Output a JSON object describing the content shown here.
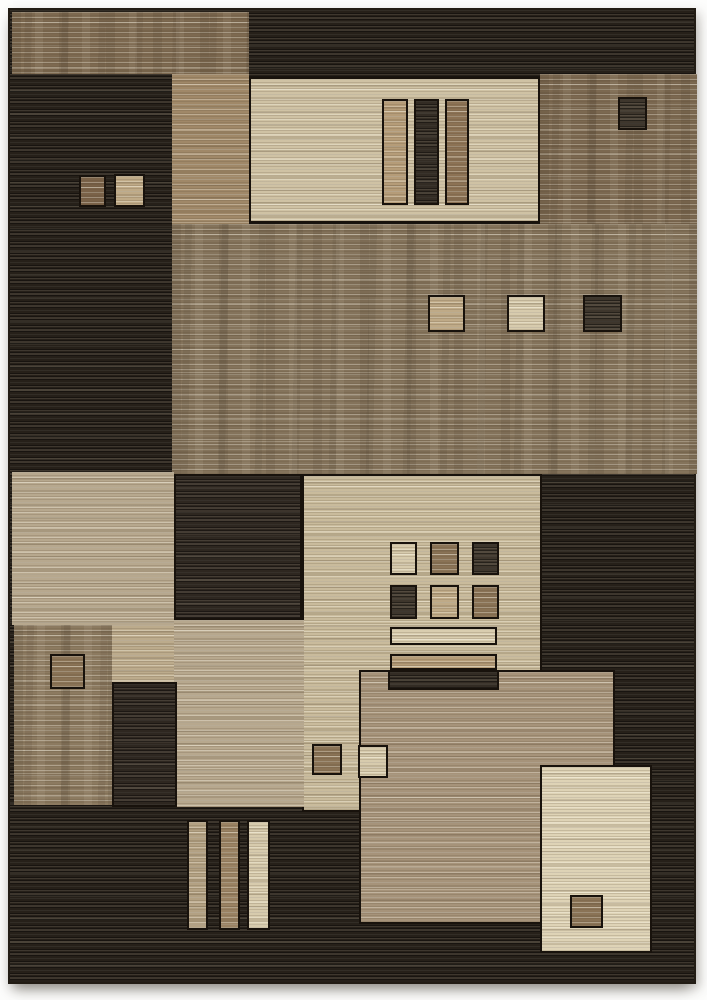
{
  "image": {
    "width": 707,
    "height": 1000,
    "background": "#fdfdfc",
    "alt": "Product photo of a modern geometric area rug with brown, tan, beige and cream color blocks and horizontal striated texture"
  },
  "rug": {
    "x": 8,
    "y": 8,
    "width": 688,
    "height": 976,
    "base_fill": "darkBase",
    "edge_color": "#221c14"
  },
  "palette": {
    "darkBase": "#262019",
    "dark2": "#2e2720",
    "brownTop": "#7d6950",
    "brownRight": "#7b6850",
    "tanColumn": "#a08868",
    "cream": "#cfc2a4",
    "creamBright": "#d9cdaf",
    "tanField": "#84735b",
    "beige": "#b7a88e",
    "beigeLow": "#bcab8c",
    "creamMid": "#c9bb9c",
    "tanLow": "#a6937a",
    "brownLow": "#8c7a60",
    "barTan": "#b59c78",
    "barBrown": "#8c7254",
    "barDark": "#332c24",
    "sqDark": "#3e362c",
    "sqBrown": "#8a7356",
    "sqBrownDk": "#7a6248",
    "sqTan": "#bfaa87",
    "sqCream": "#d7cbad",
    "barTanB": "#b3a183",
    "barBrownB": "#9a8263",
    "creamBR": "#ded3b6"
  },
  "blocks": [
    {
      "name": "top-strip-brown",
      "x": 10,
      "y": 10,
      "w": 237,
      "h": 62,
      "fill": "brownTop",
      "tex": "light",
      "mottle": true,
      "border": false
    },
    {
      "name": "square-brown-top-left",
      "x": 77,
      "y": 173,
      "w": 27,
      "h": 32,
      "fill": "sqBrownDk",
      "tex": "light",
      "mottle": false,
      "border": true
    },
    {
      "name": "square-tan-top-left",
      "x": 112,
      "y": 172,
      "w": 31,
      "h": 33,
      "fill": "sqTan",
      "tex": "light",
      "mottle": false,
      "border": true
    },
    {
      "name": "tan-column",
      "x": 170,
      "y": 72,
      "w": 77,
      "h": 150,
      "fill": "tanColumn",
      "tex": "light",
      "mottle": false,
      "border": false
    },
    {
      "name": "cream-panel-top",
      "x": 247,
      "y": 75,
      "w": 291,
      "h": 146,
      "fill": "cream",
      "tex": "light",
      "mottle": false,
      "border": true
    },
    {
      "name": "bar-tan-top",
      "x": 380,
      "y": 97,
      "w": 26,
      "h": 106,
      "fill": "barTan",
      "tex": "light",
      "mottle": false,
      "border": true
    },
    {
      "name": "bar-dark-top",
      "x": 412,
      "y": 97,
      "w": 25,
      "h": 106,
      "fill": "barDark",
      "tex": "dark",
      "mottle": false,
      "border": true
    },
    {
      "name": "bar-brown-top",
      "x": 443,
      "y": 97,
      "w": 24,
      "h": 106,
      "fill": "barBrown",
      "tex": "light",
      "mottle": false,
      "border": true
    },
    {
      "name": "brown-panel-top-right",
      "x": 538,
      "y": 72,
      "w": 157,
      "h": 150,
      "fill": "brownRight",
      "tex": "light",
      "mottle": true,
      "border": false
    },
    {
      "name": "square-dark-top-right",
      "x": 616,
      "y": 95,
      "w": 29,
      "h": 33,
      "fill": "sqDark",
      "tex": "dark",
      "mottle": false,
      "border": true
    },
    {
      "name": "tan-field",
      "x": 170,
      "y": 222,
      "w": 525,
      "h": 250,
      "fill": "tanField",
      "tex": "light",
      "mottle": true,
      "border": false
    },
    {
      "name": "square-tan-field",
      "x": 426,
      "y": 293,
      "w": 37,
      "h": 37,
      "fill": "sqTan",
      "tex": "light",
      "mottle": false,
      "border": true
    },
    {
      "name": "square-cream-field",
      "x": 505,
      "y": 293,
      "w": 38,
      "h": 37,
      "fill": "sqCream",
      "tex": "light",
      "mottle": false,
      "border": true
    },
    {
      "name": "square-dark-field",
      "x": 581,
      "y": 293,
      "w": 39,
      "h": 37,
      "fill": "sqDark",
      "tex": "dark",
      "mottle": false,
      "border": true
    },
    {
      "name": "beige-panel-left",
      "x": 10,
      "y": 470,
      "w": 162,
      "h": 153,
      "fill": "beige",
      "tex": "light",
      "mottle": false,
      "border": false
    },
    {
      "name": "dark-square-mid",
      "x": 172,
      "y": 472,
      "w": 128,
      "h": 146,
      "fill": "dark2",
      "tex": "dark",
      "mottle": false,
      "border": true
    },
    {
      "name": "cream-panel-mid",
      "x": 300,
      "y": 472,
      "w": 240,
      "h": 338,
      "fill": "creamMid",
      "tex": "light",
      "mottle": false,
      "border": true
    },
    {
      "name": "grid-square-cream",
      "x": 388,
      "y": 540,
      "w": 27,
      "h": 33,
      "fill": "sqCream",
      "tex": "light",
      "mottle": false,
      "border": true
    },
    {
      "name": "grid-square-brown",
      "x": 428,
      "y": 540,
      "w": 29,
      "h": 33,
      "fill": "sqBrown",
      "tex": "light",
      "mottle": false,
      "border": true
    },
    {
      "name": "grid-square-dark",
      "x": 470,
      "y": 540,
      "w": 27,
      "h": 33,
      "fill": "sqDark",
      "tex": "dark",
      "mottle": false,
      "border": true
    },
    {
      "name": "grid-square-dark-2",
      "x": 388,
      "y": 583,
      "w": 27,
      "h": 34,
      "fill": "sqDark",
      "tex": "dark",
      "mottle": false,
      "border": true
    },
    {
      "name": "grid-square-tan",
      "x": 428,
      "y": 583,
      "w": 29,
      "h": 34,
      "fill": "sqTan",
      "tex": "light",
      "mottle": false,
      "border": true
    },
    {
      "name": "grid-square-brown-2",
      "x": 470,
      "y": 583,
      "w": 27,
      "h": 34,
      "fill": "sqBrown",
      "tex": "light",
      "mottle": false,
      "border": true
    },
    {
      "name": "bar-cream-mid",
      "x": 388,
      "y": 625,
      "w": 107,
      "h": 18,
      "fill": "creamBright",
      "tex": "light",
      "mottle": false,
      "border": true
    },
    {
      "name": "bar-tan-mid",
      "x": 388,
      "y": 652,
      "w": 107,
      "h": 16,
      "fill": "barTan",
      "tex": "light",
      "mottle": false,
      "border": true
    },
    {
      "name": "beige-center-low",
      "x": 172,
      "y": 618,
      "w": 130,
      "h": 187,
      "fill": "beige",
      "tex": "light",
      "mottle": false,
      "border": false
    },
    {
      "name": "beige-notch",
      "x": 110,
      "y": 623,
      "w": 62,
      "h": 57,
      "fill": "beigeLow",
      "tex": "light",
      "mottle": false,
      "border": false
    },
    {
      "name": "brown-panel-low-left",
      "x": 12,
      "y": 623,
      "w": 98,
      "h": 180,
      "fill": "brownLow",
      "tex": "light",
      "mottle": true,
      "border": false
    },
    {
      "name": "square-outline-low-left",
      "x": 48,
      "y": 652,
      "w": 35,
      "h": 35,
      "fill": "sqBrown",
      "tex": "light",
      "mottle": false,
      "border": true
    },
    {
      "name": "dark-column-low",
      "x": 110,
      "y": 680,
      "w": 65,
      "h": 125,
      "fill": "dark2",
      "tex": "dark",
      "mottle": false,
      "border": true
    },
    {
      "name": "tan-panel-low",
      "x": 357,
      "y": 668,
      "w": 256,
      "h": 254,
      "fill": "tanLow",
      "tex": "light",
      "mottle": false,
      "border": true
    },
    {
      "name": "bar-dark-cross",
      "x": 386,
      "y": 668,
      "w": 111,
      "h": 20,
      "fill": "barDark",
      "tex": "dark",
      "mottle": false,
      "border": true
    },
    {
      "name": "square-brown-mid",
      "x": 310,
      "y": 742,
      "w": 30,
      "h": 31,
      "fill": "sqBrown",
      "tex": "light",
      "mottle": false,
      "border": true
    },
    {
      "name": "square-cream-small",
      "x": 356,
      "y": 743,
      "w": 30,
      "h": 33,
      "fill": "sqCream",
      "tex": "light",
      "mottle": false,
      "border": true
    },
    {
      "name": "bar-bottom-tan",
      "x": 185,
      "y": 818,
      "w": 21,
      "h": 110,
      "fill": "barTanB",
      "tex": "light",
      "mottle": false,
      "border": true
    },
    {
      "name": "bar-bottom-brown",
      "x": 217,
      "y": 818,
      "w": 21,
      "h": 110,
      "fill": "barBrownB",
      "tex": "light",
      "mottle": false,
      "border": true
    },
    {
      "name": "bar-bottom-cream",
      "x": 245,
      "y": 818,
      "w": 23,
      "h": 110,
      "fill": "sqCream",
      "tex": "light",
      "mottle": false,
      "border": true
    },
    {
      "name": "cream-panel-bottom-right",
      "x": 538,
      "y": 763,
      "w": 112,
      "h": 188,
      "fill": "creamBR",
      "tex": "light",
      "mottle": false,
      "border": true
    },
    {
      "name": "square-brown-bottom-right",
      "x": 568,
      "y": 893,
      "w": 33,
      "h": 33,
      "fill": "sqBrown",
      "tex": "light",
      "mottle": false,
      "border": true
    }
  ]
}
